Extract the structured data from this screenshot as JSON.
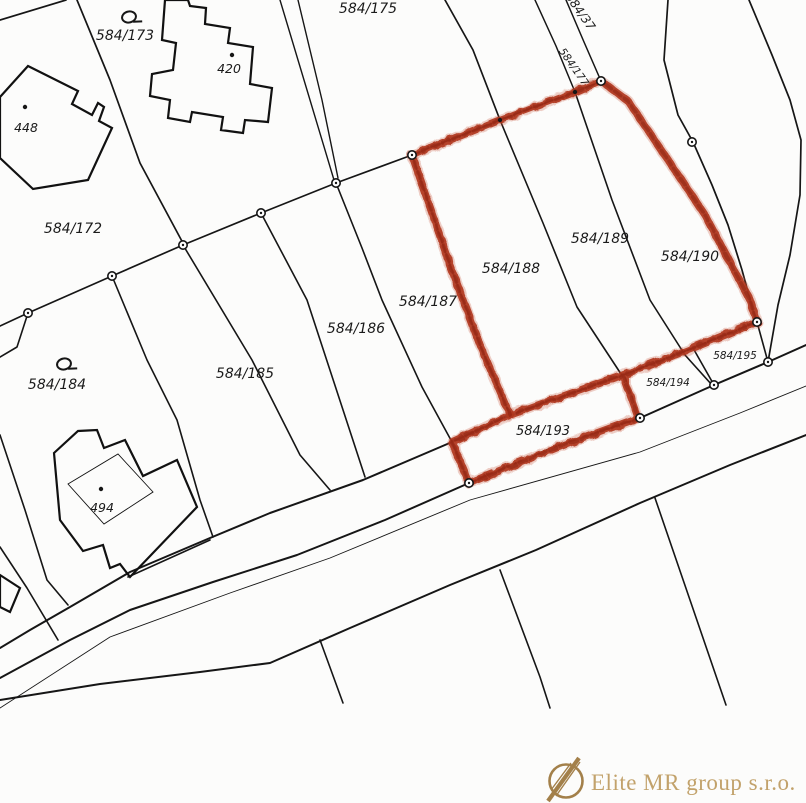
{
  "map": {
    "title": "cadastral-parcel-map",
    "line_color": "#161616",
    "highlight_color": "#b0371f",
    "background": "#fcfcfb",
    "parcel_labels": [
      {
        "text": "584/172",
        "x": 73,
        "y": 233,
        "size": 14,
        "rot": 0
      },
      {
        "text": "584/173",
        "x": 125,
        "y": 40,
        "size": 14,
        "rot": 0
      },
      {
        "text": "584/175",
        "x": 368,
        "y": 13,
        "size": 14,
        "rot": 0
      },
      {
        "text": "584/184",
        "x": 57,
        "y": 389,
        "size": 14,
        "rot": 0
      },
      {
        "text": "584/185",
        "x": 245,
        "y": 378,
        "size": 14,
        "rot": 0
      },
      {
        "text": "584/186",
        "x": 356,
        "y": 333,
        "size": 14,
        "rot": 0
      },
      {
        "text": "584/187",
        "x": 428,
        "y": 306,
        "size": 14,
        "rot": 0
      },
      {
        "text": "584/188",
        "x": 511,
        "y": 273,
        "size": 14,
        "rot": 0
      },
      {
        "text": "584/189",
        "x": 600,
        "y": 243,
        "size": 14,
        "rot": 0
      },
      {
        "text": "584/190",
        "x": 690,
        "y": 261,
        "size": 14,
        "rot": 0
      },
      {
        "text": "584/193",
        "x": 543,
        "y": 435,
        "size": 13,
        "rot": 0
      },
      {
        "text": "584/194",
        "x": 668,
        "y": 386,
        "size": 10.5,
        "rot": 0
      },
      {
        "text": "584/195",
        "x": 735,
        "y": 359,
        "size": 10.5,
        "rot": 0
      },
      {
        "text": "584/37",
        "x": 577,
        "y": 14,
        "size": 12,
        "rot": 55
      },
      {
        "text": "584/177",
        "x": 571,
        "y": 69,
        "size": 10.5,
        "rot": 55
      }
    ],
    "building_labels": [
      {
        "text": "448",
        "x": 26,
        "y": 132,
        "size": 12.5,
        "rot": 0
      },
      {
        "text": "420",
        "x": 229,
        "y": 73,
        "size": 12.5,
        "rot": 0
      },
      {
        "text": "494",
        "x": 102,
        "y": 512,
        "size": 12.5,
        "rot": 0
      }
    ],
    "symbols": [
      {
        "name": "landuse-symbol",
        "x": 129,
        "y": 17
      },
      {
        "name": "landuse-symbol",
        "x": 64,
        "y": 364
      }
    ]
  },
  "watermark": {
    "company": "Elite MR group s.r.o.",
    "color": "#c2a26b",
    "icon_color": "#a3804a"
  }
}
